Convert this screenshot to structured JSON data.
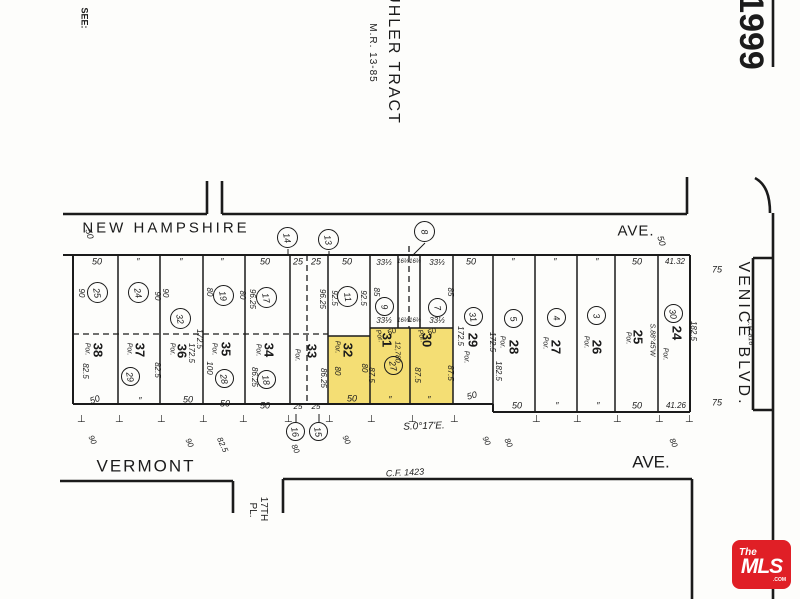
{
  "header": {
    "see_note": "SEE:",
    "tract_title": "UHLER TRACT",
    "tract_ref": "M.R. 13-85",
    "page_number": "1999"
  },
  "streets": {
    "top_name": "NEW HAMPSHIRE",
    "top_suffix": "AVE.",
    "top_width_west": "50",
    "top_width_east": "50",
    "bottom_name": "VERMONT",
    "bottom_suffix": "AVE.",
    "right_name": "VENICE BLVD.",
    "right_ref": "C.P. 816",
    "right_width_north": "75",
    "right_width_south": "75",
    "south_name_line1": "17TH",
    "south_name_line2": "PL.",
    "bearing": "S.0°17'E.",
    "cf_ref": "C.F. 1423"
  },
  "colors": {
    "highlight": "#f4de74",
    "line": "#1b1b1b",
    "logo_red": "#e01f26"
  },
  "logo": {
    "line1": "The",
    "line2": "MLS",
    "line3": ".COM"
  },
  "ticks": {
    "glyph": "⊥",
    "y": 420,
    "xs": [
      82,
      120,
      162,
      204,
      244,
      289,
      330,
      372,
      413,
      455,
      537,
      578,
      618,
      660,
      690
    ]
  },
  "bubbles": [
    {
      "n": "25",
      "x": 98,
      "y": 293,
      "r": 11
    },
    {
      "n": "24",
      "x": 139,
      "y": 293,
      "r": 11
    },
    {
      "n": "32",
      "x": 181,
      "y": 319,
      "r": 11
    },
    {
      "n": "19",
      "x": 224,
      "y": 296,
      "r": 11
    },
    {
      "n": "17",
      "x": 267,
      "y": 298,
      "r": 11
    },
    {
      "n": "11",
      "x": 348,
      "y": 297,
      "r": 11
    },
    {
      "n": "9",
      "x": 385,
      "y": 307,
      "r": 10
    },
    {
      "n": "7",
      "x": 438,
      "y": 308,
      "r": 10
    },
    {
      "n": "31",
      "x": 474,
      "y": 317,
      "r": 10
    },
    {
      "n": "5",
      "x": 514,
      "y": 319,
      "r": 10
    },
    {
      "n": "4",
      "x": 557,
      "y": 318,
      "r": 10
    },
    {
      "n": "3",
      "x": 597,
      "y": 316,
      "r": 10
    },
    {
      "n": "30",
      "x": 674,
      "y": 314,
      "r": 10
    },
    {
      "n": "29",
      "x": 131,
      "y": 377,
      "r": 10
    },
    {
      "n": "28",
      "x": 225,
      "y": 379,
      "r": 10
    },
    {
      "n": "18",
      "x": 267,
      "y": 380,
      "r": 10
    },
    {
      "n": "27",
      "x": 394,
      "y": 366,
      "r": 10
    },
    {
      "n": "14",
      "x": 288,
      "y": 238,
      "r": 11
    },
    {
      "n": "13",
      "x": 329,
      "y": 240,
      "r": 11
    },
    {
      "n": "8",
      "x": 425,
      "y": 232,
      "r": 11
    },
    {
      "n": "16",
      "x": 296,
      "y": 432,
      "r": 10
    },
    {
      "n": "15",
      "x": 319,
      "y": 432,
      "r": 10
    }
  ],
  "labels": [
    {
      "t": "50",
      "x": 97,
      "y": 262
    },
    {
      "t": "″",
      "x": 138,
      "y": 262
    },
    {
      "t": "″",
      "x": 181,
      "y": 262
    },
    {
      "t": "″",
      "x": 222,
      "y": 262
    },
    {
      "t": "50",
      "x": 265,
      "y": 262
    },
    {
      "t": "25",
      "x": 298,
      "y": 262
    },
    {
      "t": "25",
      "x": 316,
      "y": 262
    },
    {
      "t": "50",
      "x": 347,
      "y": 262
    },
    {
      "t": "33⅓",
      "x": 384,
      "y": 263,
      "s": 8
    },
    {
      "t": "16⅔",
      "x": 403,
      "y": 262,
      "s": 6
    },
    {
      "t": "16⅔",
      "x": 415,
      "y": 262,
      "s": 6
    },
    {
      "t": "33⅓",
      "x": 437,
      "y": 263,
      "s": 8
    },
    {
      "t": "50",
      "x": 471,
      "y": 262
    },
    {
      "t": "″",
      "x": 513,
      "y": 262
    },
    {
      "t": "″",
      "x": 555,
      "y": 262
    },
    {
      "t": "″",
      "x": 597,
      "y": 262
    },
    {
      "t": "50",
      "x": 637,
      "y": 262
    },
    {
      "t": "41.32",
      "x": 675,
      "y": 262,
      "s": 8
    },
    {
      "t": "33⅓",
      "x": 384,
      "y": 321,
      "s": 8
    },
    {
      "t": "16⅔",
      "x": 403,
      "y": 321,
      "s": 6
    },
    {
      "t": "16⅔",
      "x": 415,
      "y": 321,
      "s": 6
    },
    {
      "t": "33⅓",
      "x": 437,
      "y": 321,
      "s": 8
    },
    {
      "t": "50",
      "x": 392,
      "y": 332,
      "r": -25,
      "s": 8
    },
    {
      "t": "Por.",
      "x": 379,
      "y": 336,
      "r": 75,
      "s": 7
    },
    {
      "t": "50",
      "x": 432,
      "y": 332,
      "r": -25,
      "s": 8
    },
    {
      "t": "Por.",
      "x": 421,
      "y": 336,
      "r": 75,
      "s": 7
    },
    {
      "t": "50",
      "x": 95,
      "y": 400,
      "r": -20
    },
    {
      "t": "″",
      "x": 140,
      "y": 401
    },
    {
      "t": "50",
      "x": 188,
      "y": 400
    },
    {
      "t": "50",
      "x": 225,
      "y": 404
    },
    {
      "t": "50",
      "x": 265,
      "y": 406
    },
    {
      "t": "25",
      "x": 298,
      "y": 407,
      "s": 8
    },
    {
      "t": "25",
      "x": 316,
      "y": 407,
      "s": 8
    },
    {
      "t": "50",
      "x": 352,
      "y": 399
    },
    {
      "t": "″",
      "x": 390,
      "y": 400
    },
    {
      "t": "″",
      "x": 429,
      "y": 400
    },
    {
      "t": "50",
      "x": 472,
      "y": 396,
      "r": -15
    },
    {
      "t": "50",
      "x": 517,
      "y": 406
    },
    {
      "t": "″",
      "x": 557,
      "y": 406
    },
    {
      "t": "″",
      "x": 598,
      "y": 406
    },
    {
      "t": "50",
      "x": 637,
      "y": 406
    },
    {
      "t": "41.26",
      "x": 676,
      "y": 406,
      "s": 8
    },
    {
      "t": "90",
      "x": 81,
      "y": 293,
      "r": 90,
      "s": 8
    },
    {
      "t": "90",
      "x": 157,
      "y": 296,
      "r": 90,
      "s": 8
    },
    {
      "t": "90",
      "x": 165,
      "y": 293,
      "r": 90,
      "s": 8
    },
    {
      "t": "80",
      "x": 209,
      "y": 292,
      "r": 90,
      "s": 8
    },
    {
      "t": "80",
      "x": 242,
      "y": 295,
      "r": 90,
      "s": 8
    },
    {
      "t": "96.25",
      "x": 252,
      "y": 299,
      "r": 90,
      "s": 8
    },
    {
      "t": "96.25",
      "x": 322,
      "y": 299,
      "r": 90,
      "s": 8
    },
    {
      "t": "92.5",
      "x": 334,
      "y": 298,
      "r": 90,
      "s": 8
    },
    {
      "t": "92.5",
      "x": 363,
      "y": 298,
      "r": 90,
      "s": 8
    },
    {
      "t": "85",
      "x": 376,
      "y": 292,
      "r": 90,
      "s": 8
    },
    {
      "t": "85",
      "x": 450,
      "y": 292,
      "r": 90,
      "s": 8
    },
    {
      "t": "172.5",
      "x": 460,
      "y": 336,
      "r": 90,
      "s": 8
    },
    {
      "t": "172.5",
      "x": 492,
      "y": 342,
      "r": 90,
      "s": 8
    },
    {
      "t": "172.5",
      "x": 199,
      "y": 339,
      "r": 90,
      "s": 8
    },
    {
      "t": "172.5",
      "x": 191,
      "y": 353,
      "r": 90,
      "s": 8
    },
    {
      "t": "82.5",
      "x": 85,
      "y": 371,
      "r": 90,
      "s": 8
    },
    {
      "t": "82.5",
      "x": 157,
      "y": 370,
      "r": 90,
      "s": 8
    },
    {
      "t": "100",
      "x": 209,
      "y": 368,
      "r": 90,
      "s": 8
    },
    {
      "t": "86.25",
      "x": 254,
      "y": 377,
      "r": 90,
      "s": 8
    },
    {
      "t": "86.25",
      "x": 323,
      "y": 378,
      "r": 90,
      "s": 8
    },
    {
      "t": "80",
      "x": 337,
      "y": 371,
      "r": 90,
      "s": 8
    },
    {
      "t": "80",
      "x": 364,
      "y": 368,
      "r": 90,
      "s": 8
    },
    {
      "t": "87.5",
      "x": 371,
      "y": 375,
      "r": 90,
      "s": 8
    },
    {
      "t": "87.5",
      "x": 417,
      "y": 375,
      "r": 90,
      "s": 8
    },
    {
      "t": "87.5",
      "x": 450,
      "y": 373,
      "r": 90,
      "s": 8
    },
    {
      "t": "12,780",
      "x": 397,
      "y": 352,
      "r": 90,
      "s": 7
    },
    {
      "t": "S.88°45'W",
      "x": 652,
      "y": 340,
      "r": 90,
      "s": 7
    },
    {
      "t": "182.5",
      "x": 693,
      "y": 331,
      "r": 90,
      "s": 8
    },
    {
      "t": "182.5",
      "x": 498,
      "y": 371,
      "r": 90,
      "s": 8
    },
    {
      "t": "38",
      "x": 98,
      "y": 350,
      "r": 90,
      "s": 13,
      "up": 1,
      "n": "lot-number-38"
    },
    {
      "t": "37",
      "x": 140,
      "y": 350,
      "r": 90,
      "s": 13,
      "up": 1,
      "n": "lot-number-37"
    },
    {
      "t": "36",
      "x": 182,
      "y": 351,
      "r": 90,
      "s": 13,
      "up": 1,
      "n": "lot-number-36"
    },
    {
      "t": "35",
      "x": 226,
      "y": 349,
      "r": 90,
      "s": 13,
      "up": 1,
      "n": "lot-number-35"
    },
    {
      "t": "34",
      "x": 269,
      "y": 350,
      "r": 90,
      "s": 13,
      "up": 1,
      "n": "lot-number-34"
    },
    {
      "t": "33",
      "x": 312,
      "y": 351,
      "r": 90,
      "s": 13,
      "up": 1,
      "n": "lot-number-33"
    },
    {
      "t": "32",
      "x": 348,
      "y": 350,
      "r": 90,
      "s": 13,
      "up": 1,
      "n": "lot-number-32"
    },
    {
      "t": "31",
      "x": 387,
      "y": 340,
      "r": 90,
      "s": 13,
      "up": 1,
      "n": "lot-number-31"
    },
    {
      "t": "30",
      "x": 427,
      "y": 340,
      "r": 90,
      "s": 13,
      "up": 1,
      "n": "lot-number-30"
    },
    {
      "t": "29",
      "x": 473,
      "y": 340,
      "r": 90,
      "s": 13,
      "up": 1,
      "n": "lot-number-29"
    },
    {
      "t": "28",
      "x": 514,
      "y": 347,
      "r": 90,
      "s": 13,
      "up": 1,
      "n": "lot-number-28"
    },
    {
      "t": "27",
      "x": 556,
      "y": 347,
      "r": 90,
      "s": 13,
      "up": 1,
      "n": "lot-number-27"
    },
    {
      "t": "26",
      "x": 597,
      "y": 347,
      "r": 90,
      "s": 13,
      "up": 1,
      "n": "lot-number-26"
    },
    {
      "t": "25",
      "x": 638,
      "y": 337,
      "r": 90,
      "s": 13,
      "up": 1,
      "n": "lot-number-25"
    },
    {
      "t": "24",
      "x": 677,
      "y": 333,
      "r": 90,
      "s": 13,
      "up": 1,
      "n": "lot-number-24"
    },
    {
      "t": "Por.",
      "x": 87,
      "y": 349,
      "r": 90,
      "s": 7
    },
    {
      "t": "Por.",
      "x": 129,
      "y": 349,
      "r": 90,
      "s": 7
    },
    {
      "t": "Por.",
      "x": 172,
      "y": 349,
      "r": 90,
      "s": 7
    },
    {
      "t": "Por.",
      "x": 214,
      "y": 349,
      "r": 90,
      "s": 7
    },
    {
      "t": "Por.",
      "x": 258,
      "y": 350,
      "r": 90,
      "s": 7
    },
    {
      "t": "Por.",
      "x": 297,
      "y": 355,
      "r": 90,
      "s": 7
    },
    {
      "t": "Por.",
      "x": 337,
      "y": 347,
      "r": 90,
      "s": 7
    },
    {
      "t": "Por.",
      "x": 466,
      "y": 357,
      "r": 90,
      "s": 7
    },
    {
      "t": "Por.",
      "x": 502,
      "y": 342,
      "r": 90,
      "s": 7
    },
    {
      "t": "Por.",
      "x": 545,
      "y": 343,
      "r": 90,
      "s": 7
    },
    {
      "t": "Por.",
      "x": 586,
      "y": 342,
      "r": 90,
      "s": 7
    },
    {
      "t": "Por.",
      "x": 628,
      "y": 338,
      "r": 90,
      "s": 7
    },
    {
      "t": "Por.",
      "x": 665,
      "y": 354,
      "r": 90,
      "s": 7
    },
    {
      "t": "90",
      "x": 92,
      "y": 440,
      "r": 65,
      "s": 8
    },
    {
      "t": "90",
      "x": 189,
      "y": 443,
      "r": 65,
      "s": 8
    },
    {
      "t": "82.5",
      "x": 222,
      "y": 445,
      "r": 65,
      "s": 8
    },
    {
      "t": "80",
      "x": 295,
      "y": 449,
      "r": 65,
      "s": 8
    },
    {
      "t": "90",
      "x": 346,
      "y": 440,
      "r": 65,
      "s": 8
    },
    {
      "t": "90",
      "x": 486,
      "y": 441,
      "r": 65,
      "s": 8
    },
    {
      "t": "80",
      "x": 508,
      "y": 443,
      "r": 65,
      "s": 8
    },
    {
      "t": "80",
      "x": 673,
      "y": 443,
      "r": 65,
      "s": 8
    }
  ]
}
